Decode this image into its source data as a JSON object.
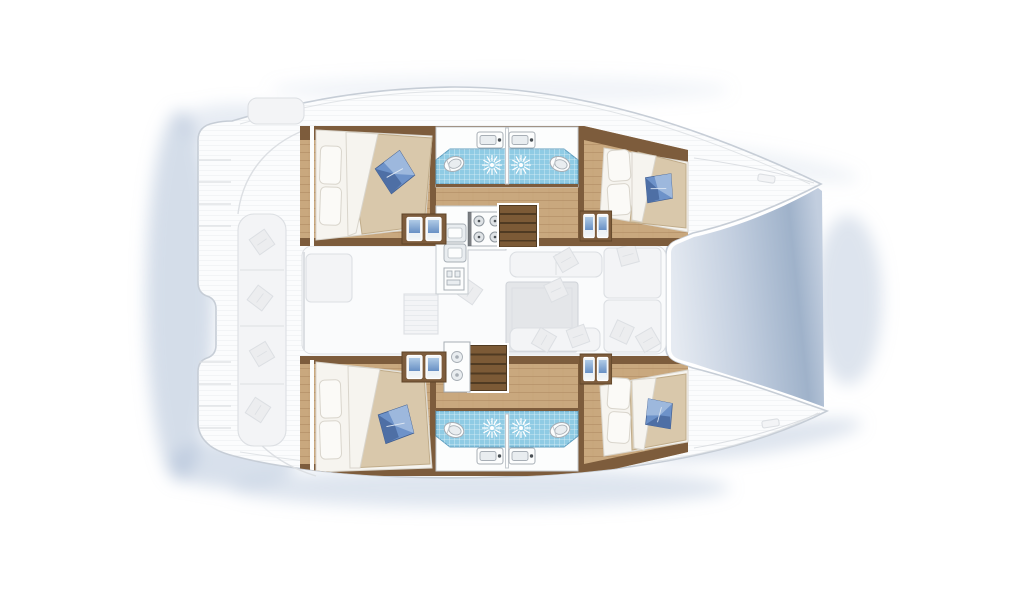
{
  "scene": {
    "type": "yacht-floorplan",
    "subject": "catamaran sailing yacht, top-down interior layout plan",
    "orientation": "bows pointing right, stern with swim platforms at left",
    "style": "salon, cockpit and outer decks drawn faded; hull cabins, bathrooms, galley and stairs drawn in full color",
    "visible_text": "none"
  },
  "palette": {
    "bg": "#ffffff",
    "shadow": "#a9bbd4",
    "gapLight": "#e6ebf2",
    "gapMid": "#c2cedf",
    "gapDark": "#9fb2ca",
    "hull": "#fbfcfd",
    "hullLine": "#c6cdd6",
    "fadedFill": "#f3f4f6",
    "fadedLine": "#dcdfe3",
    "fadedPillow": "#ecedef",
    "salonFloor": "#fafbfc",
    "tableFill": "#e4e6e9",
    "tableLine": "#ced2d7",
    "wood": "#c9a87e",
    "woodLine": "#a9835a",
    "trim": "#7d5c3c",
    "trimDark": "#5f4528",
    "stairBase": "#4f3a22",
    "stairTread": "#7c5a36",
    "duvet": "#d9c8ab",
    "duvetEdge": "#c0ac8a",
    "linen": "#f6f4ef",
    "linenLine": "#d9d5cc",
    "pillowWhite": "#fbfaf7",
    "pillowBlue": "#6d92c9",
    "pillowBlueLight": "#9db8dd",
    "pillowBlueDark": "#4e6fa5",
    "tile": "#8fcbe4",
    "tileEdge": "#5f9ec0",
    "fixture": "#fcfdfd",
    "fixtureInner": "#e9edf0",
    "fixtureLine": "#a7aeb5",
    "counterLine": "#c5cacf",
    "burnerRing": "#dfe3e6",
    "burnerDot": "#4a5055",
    "doorBlueLight": "#b0cbe6",
    "doorBlueDark": "#5d87bf"
  },
  "boat": {
    "type": "catamaran",
    "hulls": [
      "port (top)",
      "starboard (bottom)"
    ],
    "cabins": [
      {
        "id": "port-aft",
        "berth": "double",
        "white_pillows": 2,
        "accent_pillow": "blue"
      },
      {
        "id": "port-forward",
        "berth": "double",
        "white_pillows": 2,
        "accent_pillow": "blue"
      },
      {
        "id": "starboard-aft",
        "berth": "double",
        "white_pillows": 2,
        "accent_pillow": "blue"
      },
      {
        "id": "starboard-forward",
        "berth": "double",
        "white_pillows": 2,
        "accent_pillow": "blue"
      }
    ],
    "bathrooms": [
      {
        "id": "port-aft-head",
        "fixtures": [
          "toilet",
          "sink",
          "shower"
        ]
      },
      {
        "id": "port-forward-head",
        "fixtures": [
          "toilet",
          "sink",
          "shower"
        ]
      },
      {
        "id": "starboard-aft-head",
        "fixtures": [
          "toilet",
          "sink",
          "shower"
        ]
      },
      {
        "id": "starboard-forward-head",
        "fixtures": [
          "toilet",
          "sink",
          "shower"
        ]
      }
    ],
    "galley": {
      "burners": 4,
      "sinks": 2,
      "oven": 1
    },
    "appliance_portholes": 2,
    "stairs": [
      {
        "id": "port-companionway",
        "treads": 5
      },
      {
        "id": "starboard-companionway",
        "treads": 5
      }
    ],
    "lockers_with_blue_doors": 4,
    "shower_symbols": 4,
    "salon": {
      "furniture": [
        "dining-table",
        "bench-seating",
        "settee",
        "rug",
        "cushions"
      ],
      "state": "faded"
    },
    "cockpit": {
      "furniture": [
        "long-bench",
        "cushions",
        "helm-seat",
        "transom-steps"
      ],
      "state": "faded"
    }
  }
}
